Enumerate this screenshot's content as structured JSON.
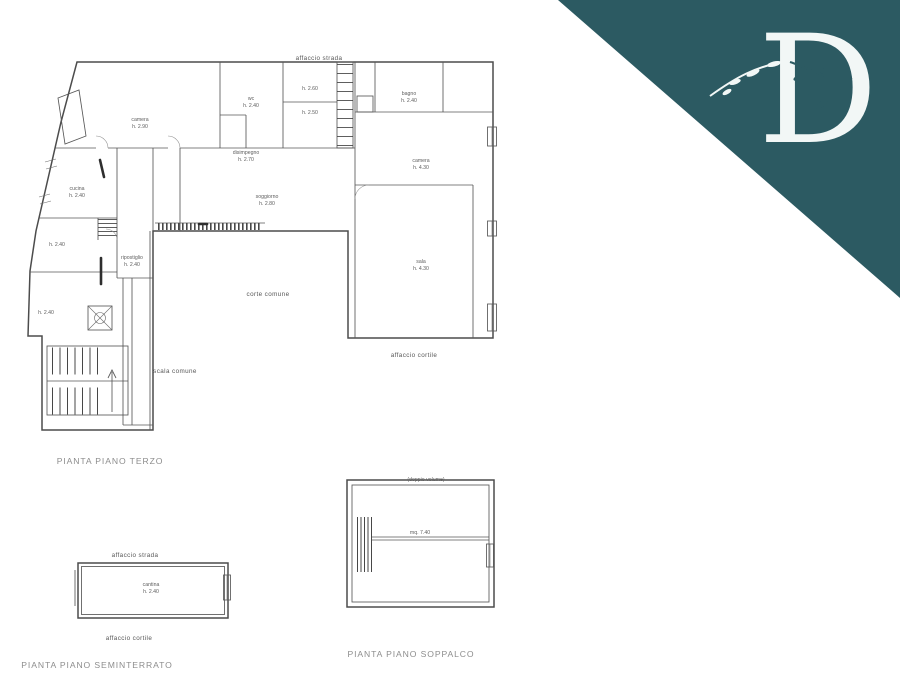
{
  "logo": {
    "letter": "D",
    "triangle_color": "#2c5a62",
    "letter_color": "#f2f7f6"
  },
  "plans": {
    "terzo": {
      "caption": "PIANTA PIANO TERZO",
      "area_labels": {
        "affaccio_top": "affaccio strada",
        "affaccio_bottom": "affaccio cortile",
        "corte": "corte comune",
        "scala": "scala comune"
      },
      "rooms": [
        {
          "name": "camera",
          "height": "h. 2.90"
        },
        {
          "name": "wc",
          "height": "h. 2.40"
        },
        {
          "name": "",
          "height": "h. 2.60"
        },
        {
          "name": "",
          "height": "h. 2.50"
        },
        {
          "name": "bagno",
          "height": "h. 2.40"
        },
        {
          "name": "camera",
          "height": "h. 4.30"
        },
        {
          "name": "sala",
          "height": "h. 4.30"
        },
        {
          "name": "disimpegno",
          "height": "h. 2.70"
        },
        {
          "name": "soggiorno",
          "height": "h. 2.80"
        },
        {
          "name": "cucina",
          "height": "h. 2.40"
        },
        {
          "name": "",
          "height": "h. 2.40"
        },
        {
          "name": "ripostiglio",
          "height": "h. 2.40"
        },
        {
          "name": "",
          "height": "h. 2.40"
        }
      ]
    },
    "seminterrato": {
      "caption": "PIANTA PIANO SEMINTERRATO",
      "area_labels": {
        "top": "affaccio strada",
        "bottom": "affaccio cortile"
      },
      "room": {
        "name": "cantina",
        "height": "h. 2.40"
      }
    },
    "soppalco": {
      "caption": "PIANTA PIANO SOPPALCO",
      "labels": {
        "top": "(doppio volume)",
        "area": "mq. 7.40"
      }
    }
  }
}
